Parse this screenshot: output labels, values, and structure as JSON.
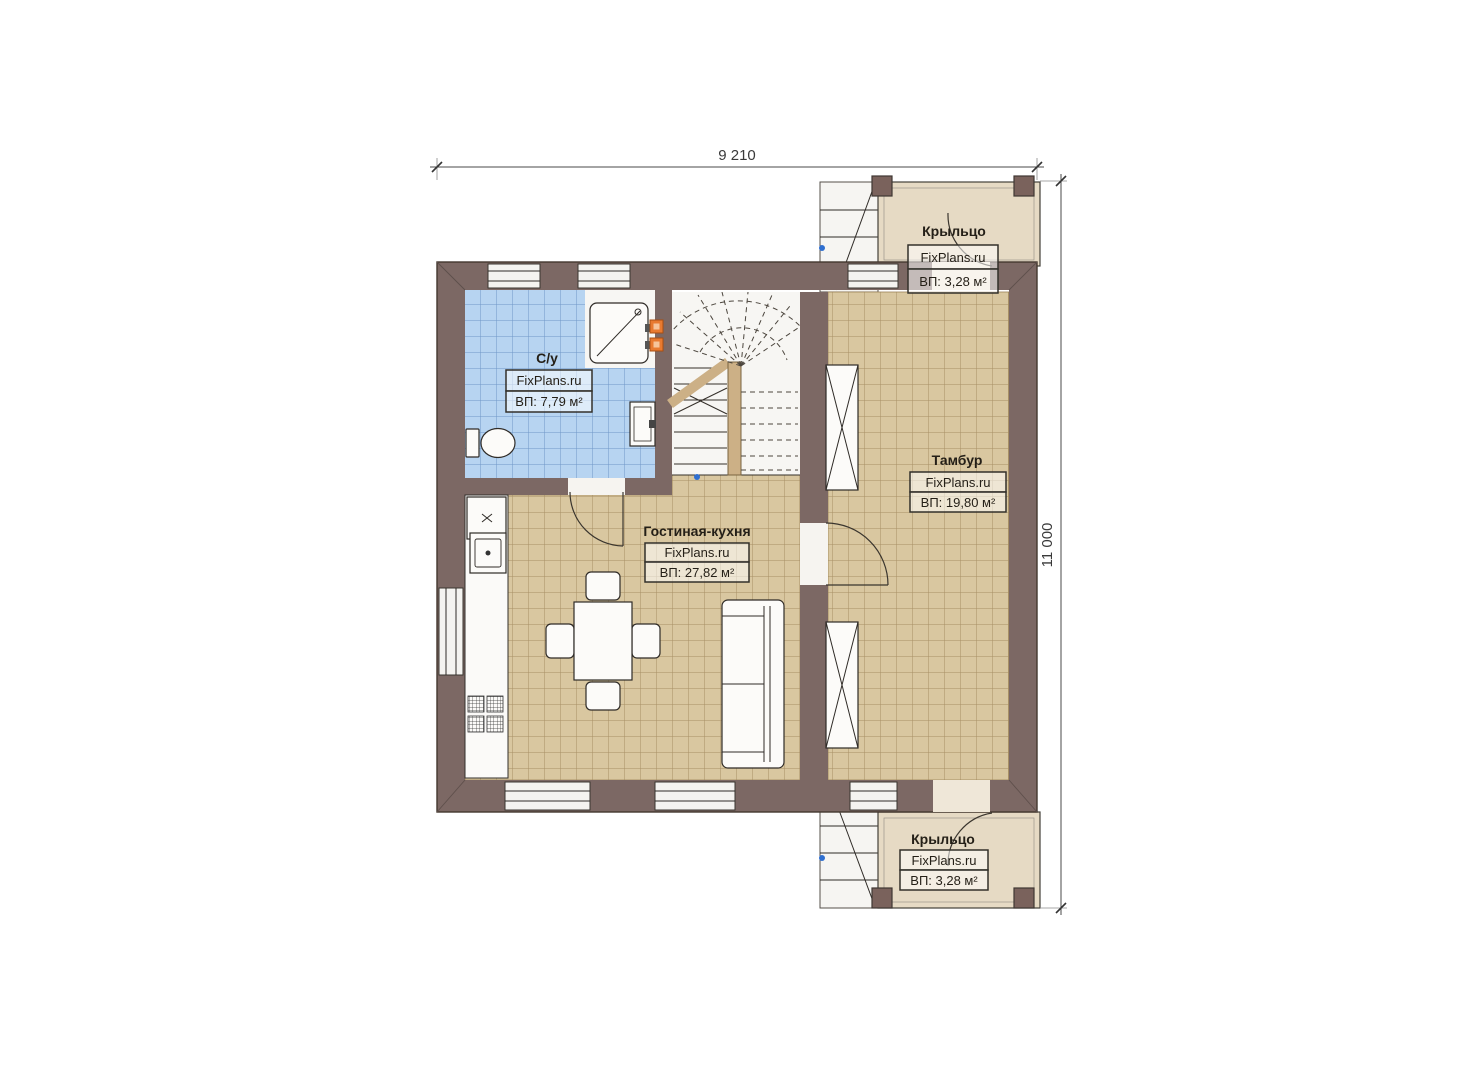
{
  "plan_title": "floor-plan",
  "dimensions": {
    "width": "9 210",
    "height": "11 000"
  },
  "rooms": {
    "porch_top": {
      "name": "Крыльцо",
      "brand": "FixPlans.ru",
      "area": "ВП: 3,28 м²"
    },
    "bathroom": {
      "name": "С/у",
      "brand": "FixPlans.ru",
      "area": "ВП: 7,79 м²"
    },
    "vestibule": {
      "name": "Тамбур",
      "brand": "FixPlans.ru",
      "area": "ВП: 19,80 м²"
    },
    "living_kitchen": {
      "name": "Гостиная-кухня",
      "brand": "FixPlans.ru",
      "area": "ВП: 27,82 м²"
    },
    "porch_bottom": {
      "name": "Крыльцо",
      "brand": "FixPlans.ru",
      "area": "ВП: 3,28 м²"
    }
  },
  "colors": {
    "wall": "#7c6864",
    "wall-dark": "#43372f",
    "tile-beige": "#d9c7a0",
    "tile-beige-line": "#a78f65",
    "tile-blue": "#b7d4f1",
    "tile-blue-line": "#6f96c7",
    "porch-floor": "#e6dac4",
    "wood": "#ccb086",
    "accent-orange": "#e87a30",
    "marker-blue": "#2f6fd0"
  }
}
